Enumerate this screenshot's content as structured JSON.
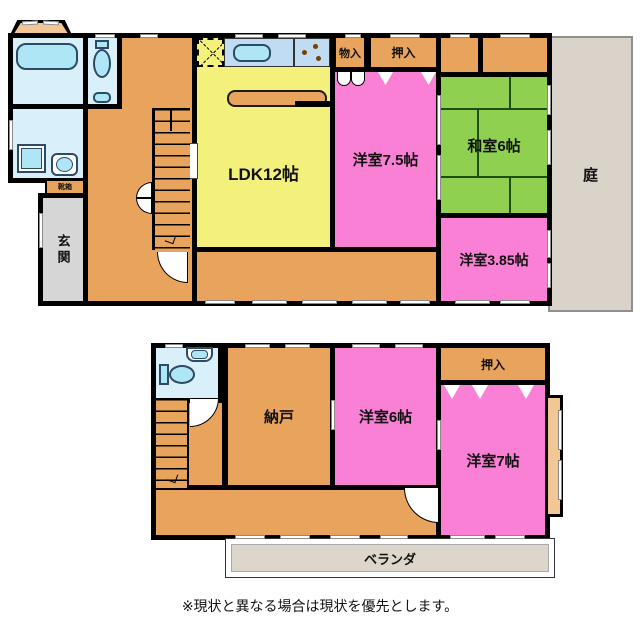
{
  "floor1": {
    "ldk_label": "LDK12帖",
    "western75_label": "洋室7.5帖",
    "japanese6_label": "和室6帖",
    "western385_label": "洋室3.85帖",
    "garden_label": "庭",
    "entrance_label": "玄関",
    "storage_mono_label": "物入",
    "closet_label": "押入",
    "shoebox_label": "靴箱"
  },
  "floor2": {
    "storeroom_label": "納戸",
    "western6_label": "洋室6帖",
    "western7_label": "洋室7帖",
    "closet_label": "押入",
    "veranda_label": "ベランダ"
  },
  "disclaimer": "※現状と異なる場合は現状を優先とします。",
  "colors": {
    "wall": "#000000",
    "hall_orange": "#E8A35D",
    "ldk_yellow": "#F4F07C",
    "room_pink": "#FA80D5",
    "tatami_green": "#8FD051",
    "water_blue": "#D9EFFA",
    "fixture_blue": "#AEE6F6",
    "kitchen_counter_blue": "#BFDCF2",
    "garden_beige": "#DAD3C9",
    "veranda_beige": "#DCD7CA",
    "entrance_gray": "#D6D6D6",
    "baywindow_tan": "#F2C795"
  }
}
